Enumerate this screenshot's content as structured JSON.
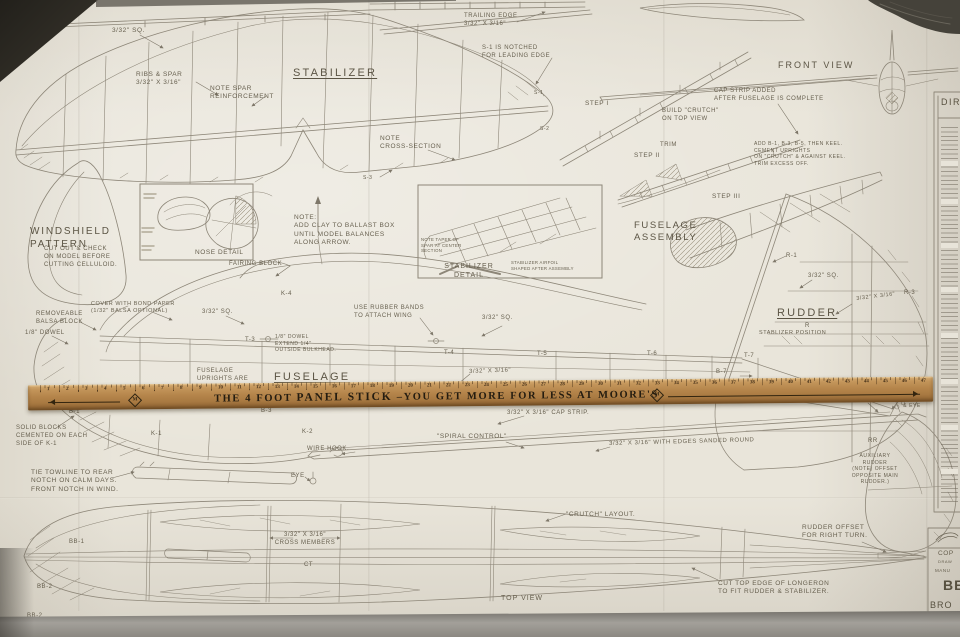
{
  "photo": {
    "backdrop": "#2d2a24",
    "paper": "#e9e5da",
    "line": "#8d8678",
    "ink": "#665f4e"
  },
  "stabilizer": {
    "title": "STABILIZER",
    "square_note": "3/32\" SQ.",
    "ribs_spar_note": "RIBS & SPAR\n3/32\" X 3/16\"",
    "spar_note": "NOTE SPAR\nREINFORCEMENT",
    "trailing_edge_note": "TRAILING EDGE\n3/32\" X 3/16\"",
    "s1_note": "S-1 IS NOTCHED\nFOR LEADING EDGE",
    "cross_section_note": "NOTE\nCROSS-SECTION",
    "s1_tag": "S-1",
    "s2_tag": "S-2",
    "s3_tag": "S-3"
  },
  "windshield": {
    "title": "WINDSHIELD\nPATTERN",
    "instructions": "CUT OUT & CHECK\nON MODEL BEFORE\nCUTTING CELLULOID."
  },
  "nose_detail": {
    "caption": "NOSE DETAIL"
  },
  "balance_note": {
    "text": "NOTE:\nADD CLAY TO BALLAST BOX\nUNTIL MODEL BALANCES\nALONG ARROW."
  },
  "stabilizer_detail": {
    "caption": "STABILIZER\nDETAIL",
    "taper_note": "NOTE TAPER OF\nSPAR AT CENTER\nSECTION",
    "airfoil_note": "STABILIZER AIRFOIL\nSHAPED AFTER ASSEMBLY"
  },
  "assembly": {
    "title": "FUSELAGE\nASSEMBLY",
    "step1": "STEP I",
    "step2": "STEP II",
    "step3": "STEP III",
    "trim": "TRIM",
    "build_crutch_note": "BUILD \"CRUTCH\"\nON TOP VIEW",
    "cap_strip_note": "CAP STRIP ADDED\nAFTER FUSELAGE IS COMPLETE",
    "keel_note": "ADD B-1, B-3, B-5, THEN KEEL.\nCEMENT UPRIGHTS\nON \"CRUTCH\" & AGAINST KEEL.\nTRIM EXCESS OFF."
  },
  "front_view": {
    "title": "FRONT VIEW"
  },
  "directions_panel": {
    "title": "DIRE"
  },
  "rudder": {
    "title": "RUDDER",
    "r_label": "R",
    "r1": "R-1",
    "r3": "R-3",
    "square_note": "3/32\" SQ.",
    "strip_note": "3/32\" X 3/16\"",
    "stab_position": "STABLIZER POSITION",
    "t7": "T-7",
    "b7": "B-7"
  },
  "fuselage": {
    "title": "FUSELAGE",
    "uprights_note": "FUSELAGE\nUPRIGHTS ARE",
    "fairing_block": "FAIRING BLOCK",
    "k4": "K-4",
    "cover_note": "COVER WITH BOND PAPER\n(1/32\" BALSA OPTIONAL)",
    "removable_note": "REMOVEABLE\nBALSA BLOCK",
    "dowel_note": "1/8\" DOWEL",
    "square_note_left": "3/32\" SQ.",
    "rubber_bands_note": "USE RUBBER BANDS\nTO ATTACH WING",
    "square_note_right": "3/32\" SQ.",
    "dowel_extend_note": "1/8\" DOWEL\nEXTEND 1/4\"\nOUTSIDE BULKHEAD.",
    "t3": "T-3",
    "t4": "T-4",
    "t5": "T-5",
    "t6": "T-6",
    "strip_note": "3/32\" X 3/16\""
  },
  "belly": {
    "solid_blocks_note": "SOLID BLOCKS\nCEMENTED ON EACH\nSIDE OF K-1",
    "b1": "B-1",
    "k1": "K-1",
    "b3": "B-3",
    "k2": "K-2",
    "cap_strip_note": "3/32\" X 3/16\" CAP STRIP.",
    "spiral_control": "\"SPIRAL CONTROL\"",
    "wire_hook": "WIRE HOOK.",
    "eye": "EYE",
    "sanded_note": "3/32\" X 3/16\" WITH EDGES SANDED ROUND",
    "towline_note": "TIE TOWLINE TO REAR\nNOTCH ON CALM DAYS.\nFRONT NOTCH IN WIND.",
    "hook_eye": "HOOK\n& EYE",
    "r4": "R-4"
  },
  "aux_rudder": {
    "rr": "RR",
    "note": "AUXILIARY\nRUDDER\n(NOTE) OFFSET\nOPPOSITE MAIN\nRUDDER.)"
  },
  "top_view": {
    "title": "TOP VIEW",
    "bb1": "BB-1",
    "bb2": "BB-2",
    "bb2_pattern": "BB-2",
    "cross_members_note": "3/32\" X 3/16\"\nCROSS MEMBERS",
    "ct": "CT",
    "crutch_layout": "\"CRUTCH\" LAYOUT.",
    "rudder_offset_note": "RUDDER OFFSET\nFOR RIGHT TURN.",
    "longeron_note": "CUT TOP EDGE OF LONGERON\nTO FIT RUDDER & STABILIZER."
  },
  "title_block": {
    "line1": "COP",
    "line2": "DRAW",
    "line3": "MANU",
    "line4": "BE",
    "line5": "BRO"
  },
  "ruler": {
    "brand_prefix": "THE 4 FOOT ",
    "brand_bold": "PANEL STICK",
    "brand_suffix": " –YOU GET MORE FOR LESS AT MOORE'S",
    "logo_letter": "M",
    "first_number": 1,
    "last_number": 47
  }
}
